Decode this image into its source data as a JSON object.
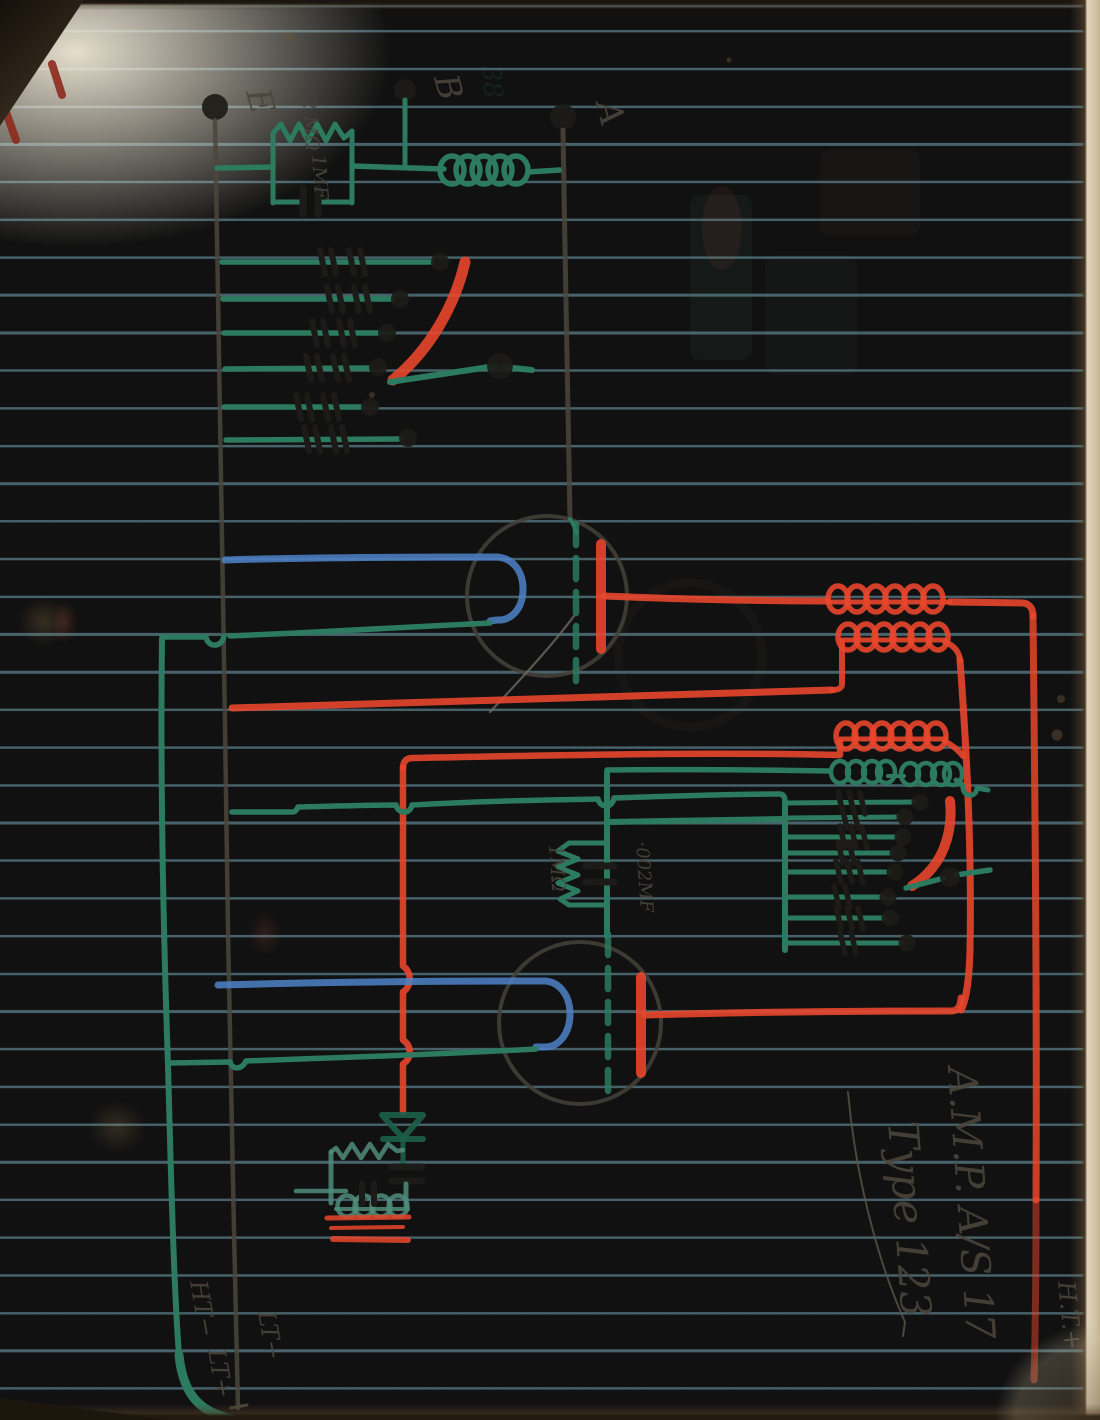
{
  "doc": {
    "kind": "hand-drawn wireless receiver circuit on ruled notebook page",
    "annotation": {
      "line1": "A.M.P. A/S 17",
      "line2": "Type 123"
    },
    "terminals": {
      "e": "E",
      "b": "B",
      "a": "A"
    },
    "labels": {
      "top_resistor": "·2 MΩ",
      "top_capacitor": "1MF",
      "grid_leak_resistor": "1MΩ",
      "grid_capacitor": "·002MF"
    },
    "rails": {
      "ht_plus": "H.T.+",
      "ht_minus": "HT−",
      "lt_plus": "LT+",
      "lt_minus": "LT−"
    },
    "ghost_text": "38",
    "colors": {
      "green-pencil": "#2c7a5f",
      "teal-pencil": "#4f8d7a",
      "red-pencil": "#e8462c",
      "blue-pencil": "#4d82c8",
      "graphite": "#4b463c",
      "ink": "#1c1b17",
      "ruled-line": "#7db3c4",
      "paper": "#eadfc6"
    }
  }
}
